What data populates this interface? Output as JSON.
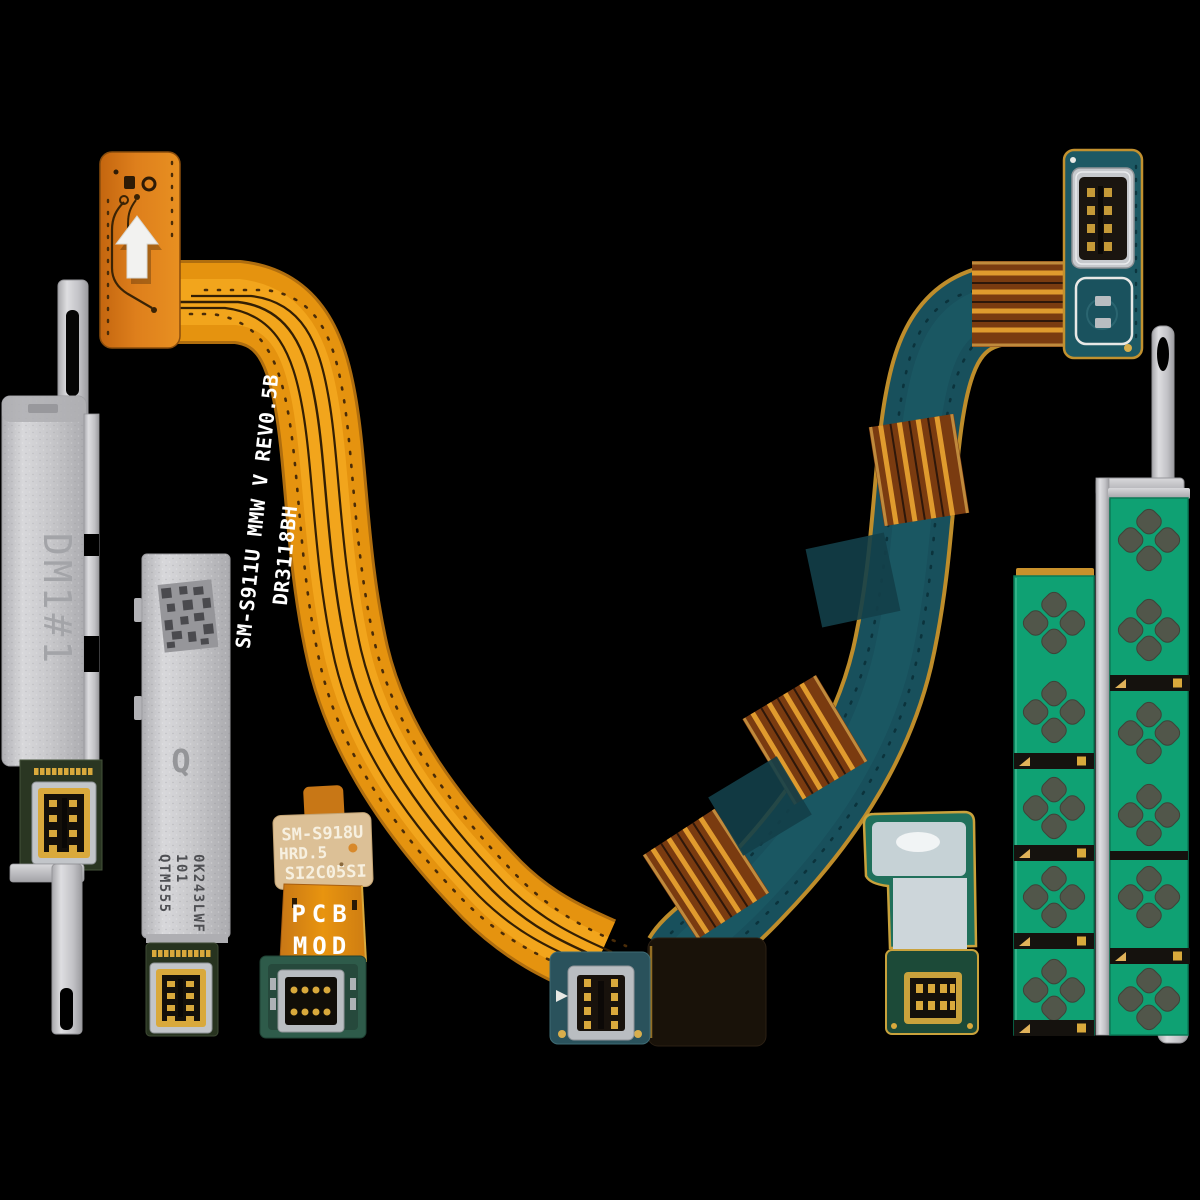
{
  "image": {
    "description": "Product photo of a Samsung 5G mmWave antenna flex cable and module set on a black background",
    "background_color": "#000000"
  },
  "colors": {
    "background": "#000000",
    "flex_orange": "#E5930F",
    "flex_teal": "#18505C",
    "copper": "#7A3B10",
    "gold": "#D9A93C",
    "pcb_green": "#0FA173",
    "antenna_patch": "#51564A",
    "metal_silver": "#C7C7CA"
  },
  "parts": {
    "orange_flex_cable": {
      "label": "orange mmWave antenna flex cable",
      "marking_line1": "SM-S911U MMW V REV0.5B",
      "marking_line2": "DR3118BH",
      "arrow_sticker_icon": "arrow-up",
      "base_color": "#E5930F"
    },
    "teal_flex_cable": {
      "label": "teal mmWave antenna flex cable",
      "base_color": "#18505C",
      "copper_color": "#7A3B10"
    },
    "metal_bracket_left": {
      "label": "metal shield bracket",
      "marking": "DM1#1",
      "color": "#C7C7CA"
    },
    "qtm_antenna_module": {
      "label": "mmWave antenna module",
      "logo": "Q",
      "marking_line1": "QTM555",
      "marking_line2": "101",
      "marking_line3": "0K243LWF",
      "color": "#C7C7CA"
    },
    "pcb_mod_flex": {
      "label": "PCB module flex cable",
      "sticker_line1": "SM-S918U",
      "sticker_line2": "HRD.5",
      "sticker_line3": "SI2C05SI",
      "marking_line1": "PCB",
      "marking_line2": "MOD",
      "sticker_color": "#DCC096"
    },
    "small_antenna_flex": {
      "label": "small antenna flex cable",
      "flex_color": "#20705B"
    },
    "antenna_strip_left": {
      "label": "segmented mmWave antenna strip",
      "board_color": "#0FA173",
      "patch_color": "#51564A"
    },
    "antenna_strip_right": {
      "label": "segmented mmWave antenna strip",
      "board_color": "#0FA173",
      "patch_color": "#51564A"
    },
    "metal_bracket_right": {
      "label": "thin metal bracket with mounting holes",
      "color": "#C7C7CA"
    }
  }
}
